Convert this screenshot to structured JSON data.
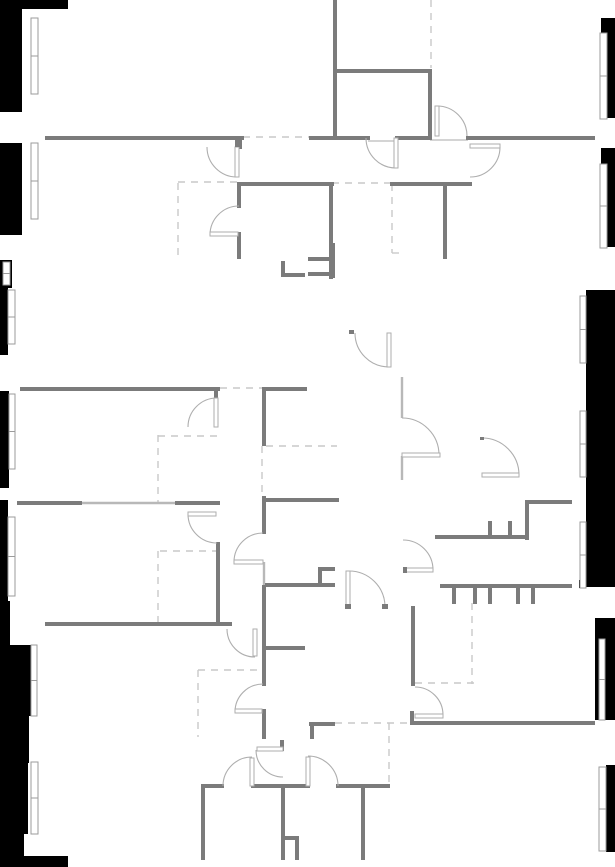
{
  "floorplan": {
    "canvas": {
      "width": 615,
      "height": 867
    },
    "colors": {
      "background": "#ffffff",
      "outside": "#000000",
      "wall": "#7b7b7b",
      "light_wall": "#b8b8b8",
      "dashed": "#c9c9c9",
      "arc": "#aeaeae",
      "sill": "#c6c6c6",
      "window_stroke": "#9b9b9b",
      "window_fill": "#ffffff"
    },
    "walls": [
      [
        47,
        138,
        242,
        138
      ],
      [
        240,
        138,
        240,
        147
      ],
      [
        311,
        138,
        368,
        138
      ],
      [
        397,
        138,
        430,
        138
      ],
      [
        468,
        138,
        593,
        138
      ],
      [
        335,
        0,
        335,
        138
      ],
      [
        335,
        71,
        430,
        71
      ],
      [
        430,
        71,
        430,
        138
      ],
      [
        240,
        184,
        332,
        184
      ],
      [
        392,
        184,
        470,
        184
      ],
      [
        331,
        184,
        331,
        277
      ],
      [
        445,
        184,
        445,
        257
      ],
      [
        239,
        184,
        239,
        206
      ],
      [
        239,
        234,
        239,
        257
      ],
      [
        283,
        263,
        283,
        275
      ],
      [
        283,
        275,
        303,
        275
      ],
      [
        333,
        245,
        333,
        276
      ],
      [
        310,
        259,
        333,
        259
      ],
      [
        310,
        274,
        333,
        274
      ],
      [
        22,
        389,
        218,
        389
      ],
      [
        216,
        389,
        216,
        397
      ],
      [
        264,
        389,
        264,
        444
      ],
      [
        264,
        389,
        305,
        389
      ],
      [
        19,
        503,
        80,
        503
      ],
      [
        177,
        503,
        218,
        503
      ],
      [
        218,
        544,
        218,
        624
      ],
      [
        47,
        624,
        230,
        624
      ],
      [
        266,
        500,
        337,
        500
      ],
      [
        264,
        498,
        264,
        532
      ],
      [
        267,
        585,
        333,
        585
      ],
      [
        320,
        569,
        320,
        585
      ],
      [
        320,
        569,
        333,
        569
      ],
      [
        264,
        587,
        264,
        628
      ],
      [
        264,
        628,
        264,
        684
      ],
      [
        267,
        648,
        303,
        648
      ],
      [
        264,
        711,
        264,
        737
      ],
      [
        311,
        724,
        333,
        724
      ],
      [
        312,
        724,
        312,
        737
      ],
      [
        527,
        502,
        570,
        502
      ],
      [
        527,
        502,
        527,
        538
      ],
      [
        437,
        537,
        527,
        537
      ],
      [
        490,
        523,
        490,
        537
      ],
      [
        510,
        523,
        510,
        537
      ],
      [
        442,
        586,
        570,
        586
      ],
      [
        454,
        586,
        454,
        602
      ],
      [
        475,
        586,
        475,
        602
      ],
      [
        490,
        586,
        490,
        602
      ],
      [
        518,
        586,
        518,
        602
      ],
      [
        533,
        586,
        533,
        602
      ],
      [
        412,
        723,
        593,
        723
      ],
      [
        412,
        713,
        412,
        723
      ],
      [
        413,
        608,
        413,
        684
      ],
      [
        203,
        786,
        222,
        786
      ],
      [
        253,
        786,
        308,
        786
      ],
      [
        338,
        786,
        388,
        786
      ],
      [
        203,
        786,
        203,
        858
      ],
      [
        283,
        786,
        283,
        858
      ],
      [
        285,
        838,
        297,
        838
      ],
      [
        297,
        838,
        297,
        858
      ],
      [
        363,
        788,
        363,
        858
      ],
      [
        282,
        742,
        282,
        749
      ]
    ],
    "light_walls": [
      [
        80,
        503,
        177,
        503
      ],
      [
        402,
        377,
        402,
        418
      ],
      [
        402,
        456,
        402,
        480
      ],
      [
        264,
        562,
        264,
        586
      ]
    ],
    "sills": [
      [
        368,
        141,
        397,
        141
      ],
      [
        430,
        140,
        468,
        140
      ]
    ],
    "dashed_lines": [
      [
        243,
        137,
        311,
        137
      ],
      [
        332,
        183,
        392,
        183
      ],
      [
        178,
        182,
        238,
        182
      ],
      [
        178,
        183,
        178,
        258
      ],
      [
        392,
        184,
        392,
        253
      ],
      [
        392,
        253,
        400,
        253
      ],
      [
        431,
        0,
        431,
        68
      ],
      [
        220,
        388,
        262,
        388
      ],
      [
        158,
        436,
        218,
        436
      ],
      [
        158,
        435,
        158,
        503
      ],
      [
        266,
        446,
        337,
        446
      ],
      [
        262,
        446,
        262,
        497
      ],
      [
        160,
        551,
        217,
        551
      ],
      [
        158,
        551,
        158,
        624
      ],
      [
        198,
        670,
        262,
        670
      ],
      [
        198,
        670,
        198,
        737
      ],
      [
        335,
        723,
        410,
        723
      ],
      [
        389,
        723,
        389,
        783
      ],
      [
        415,
        683,
        477,
        683
      ],
      [
        472,
        603,
        472,
        684
      ]
    ],
    "doors": [
      {
        "cx": 237,
        "cy": 147,
        "r": 30,
        "from": "W",
        "to": "S",
        "leaf": [
          237,
          147,
          237,
          177
        ],
        "ticks": [
          [
            235,
            137,
            5,
            10
          ]
        ]
      },
      {
        "cx": 239,
        "cy": 235,
        "r": 29,
        "from": "N",
        "to": "W",
        "leaf": [
          210,
          234,
          238,
          234
        ]
      },
      {
        "cx": 396,
        "cy": 138,
        "r": 30,
        "from": "W",
        "to": "S",
        "leaf": [
          396,
          138,
          396,
          168
        ]
      },
      {
        "cx": 437,
        "cy": 136,
        "r": 30,
        "from": "N",
        "to": "E",
        "leaf": [
          437,
          106,
          437,
          136
        ]
      },
      {
        "cx": 470,
        "cy": 147,
        "r": 30,
        "from": "E",
        "to": "S",
        "leaf": [
          470,
          146,
          500,
          146
        ]
      },
      {
        "cx": 217,
        "cy": 427,
        "r": 29,
        "from": "N",
        "to": "W",
        "leaf": [
          216,
          398,
          216,
          427
        ]
      },
      {
        "cx": 217,
        "cy": 514,
        "r": 29,
        "from": "W",
        "to": "S",
        "leaf": [
          188,
          514,
          216,
          514
        ]
      },
      {
        "cx": 263,
        "cy": 562,
        "r": 29,
        "from": "N",
        "to": "W",
        "leaf": [
          234,
          562,
          263,
          562
        ]
      },
      {
        "cx": 255,
        "cy": 629,
        "r": 28,
        "from": "W",
        "to": "S",
        "leaf": [
          255,
          629,
          255,
          656
        ]
      },
      {
        "cx": 263,
        "cy": 712,
        "r": 28,
        "from": "N",
        "to": "W",
        "leaf": [
          235,
          711,
          262,
          711
        ]
      },
      {
        "cx": 402,
        "cy": 455,
        "r": 37,
        "from": "N",
        "to": "E",
        "leaf": [
          402,
          455,
          440,
          455
        ]
      },
      {
        "cx": 389,
        "cy": 333,
        "r": 34,
        "from": "W",
        "to": "S",
        "leaf": [
          389,
          333,
          389,
          367
        ],
        "ticks": [
          [
            349,
            330,
            5,
            4
          ]
        ]
      },
      {
        "cx": 482,
        "cy": 475,
        "r": 37,
        "from": "N",
        "to": "E",
        "leaf": [
          482,
          475,
          519,
          475
        ],
        "ticks": [
          [
            480,
            437,
            4,
            3
          ]
        ]
      },
      {
        "cx": 349,
        "cy": 607,
        "r": 36,
        "from": "N",
        "to": "E",
        "leaf": [
          348,
          571,
          348,
          607
        ],
        "ticks": [
          [
            345,
            604,
            6,
            5
          ],
          [
            382,
            604,
            6,
            5
          ]
        ]
      },
      {
        "cx": 403,
        "cy": 570,
        "r": 30,
        "from": "N",
        "to": "E",
        "leaf": [
          404,
          570,
          433,
          570
        ],
        "ticks": [
          [
            403,
            567,
            4,
            6
          ]
        ]
      },
      {
        "cx": 415,
        "cy": 715,
        "r": 28,
        "from": "N",
        "to": "E",
        "leaf": [
          415,
          716,
          443,
          716
        ]
      },
      {
        "cx": 252,
        "cy": 786,
        "r": 29,
        "from": "N",
        "to": "W",
        "leaf": [
          252,
          758,
          252,
          786
        ]
      },
      {
        "cx": 308,
        "cy": 786,
        "r": 30,
        "from": "N",
        "to": "E",
        "leaf": [
          308,
          757,
          308,
          786
        ]
      },
      {
        "cx": 283,
        "cy": 750,
        "r": 27,
        "from": "W",
        "to": "S",
        "leaf": [
          257,
          749,
          283,
          749
        ]
      }
    ],
    "windows": [
      [
        31,
        18,
        7,
        76
      ],
      [
        31,
        143,
        7,
        76
      ],
      [
        3,
        262,
        7,
        23
      ],
      [
        8,
        290,
        7,
        54
      ],
      [
        9,
        394,
        6,
        75
      ],
      [
        8,
        517,
        7,
        79
      ],
      [
        31,
        645,
        6,
        71
      ],
      [
        31,
        762,
        7,
        72
      ],
      [
        600,
        33,
        7,
        86
      ],
      [
        600,
        164,
        7,
        84
      ],
      [
        580,
        296,
        6,
        67
      ],
      [
        580,
        411,
        6,
        66
      ],
      [
        580,
        522,
        6,
        66
      ],
      [
        599,
        639,
        6,
        81
      ],
      [
        599,
        767,
        7,
        84
      ]
    ],
    "outside_masks": [
      [
        0,
        0,
        22,
        112
      ],
      [
        22,
        0,
        46,
        9
      ],
      [
        0,
        143,
        22,
        92
      ],
      [
        0,
        260,
        12,
        28
      ],
      [
        0,
        288,
        8,
        67
      ],
      [
        0,
        391,
        9,
        97
      ],
      [
        0,
        500,
        8,
        101
      ],
      [
        0,
        601,
        10,
        44
      ],
      [
        0,
        645,
        31,
        71
      ],
      [
        0,
        716,
        29,
        47
      ],
      [
        0,
        763,
        28,
        71
      ],
      [
        0,
        834,
        24,
        33
      ],
      [
        0,
        856,
        68,
        11
      ],
      [
        601,
        18,
        14,
        100
      ],
      [
        601,
        148,
        14,
        99
      ],
      [
        586,
        290,
        29,
        297
      ],
      [
        595,
        618,
        20,
        102
      ],
      [
        606,
        765,
        9,
        87
      ],
      [
        579,
        580,
        7,
        8
      ]
    ]
  }
}
